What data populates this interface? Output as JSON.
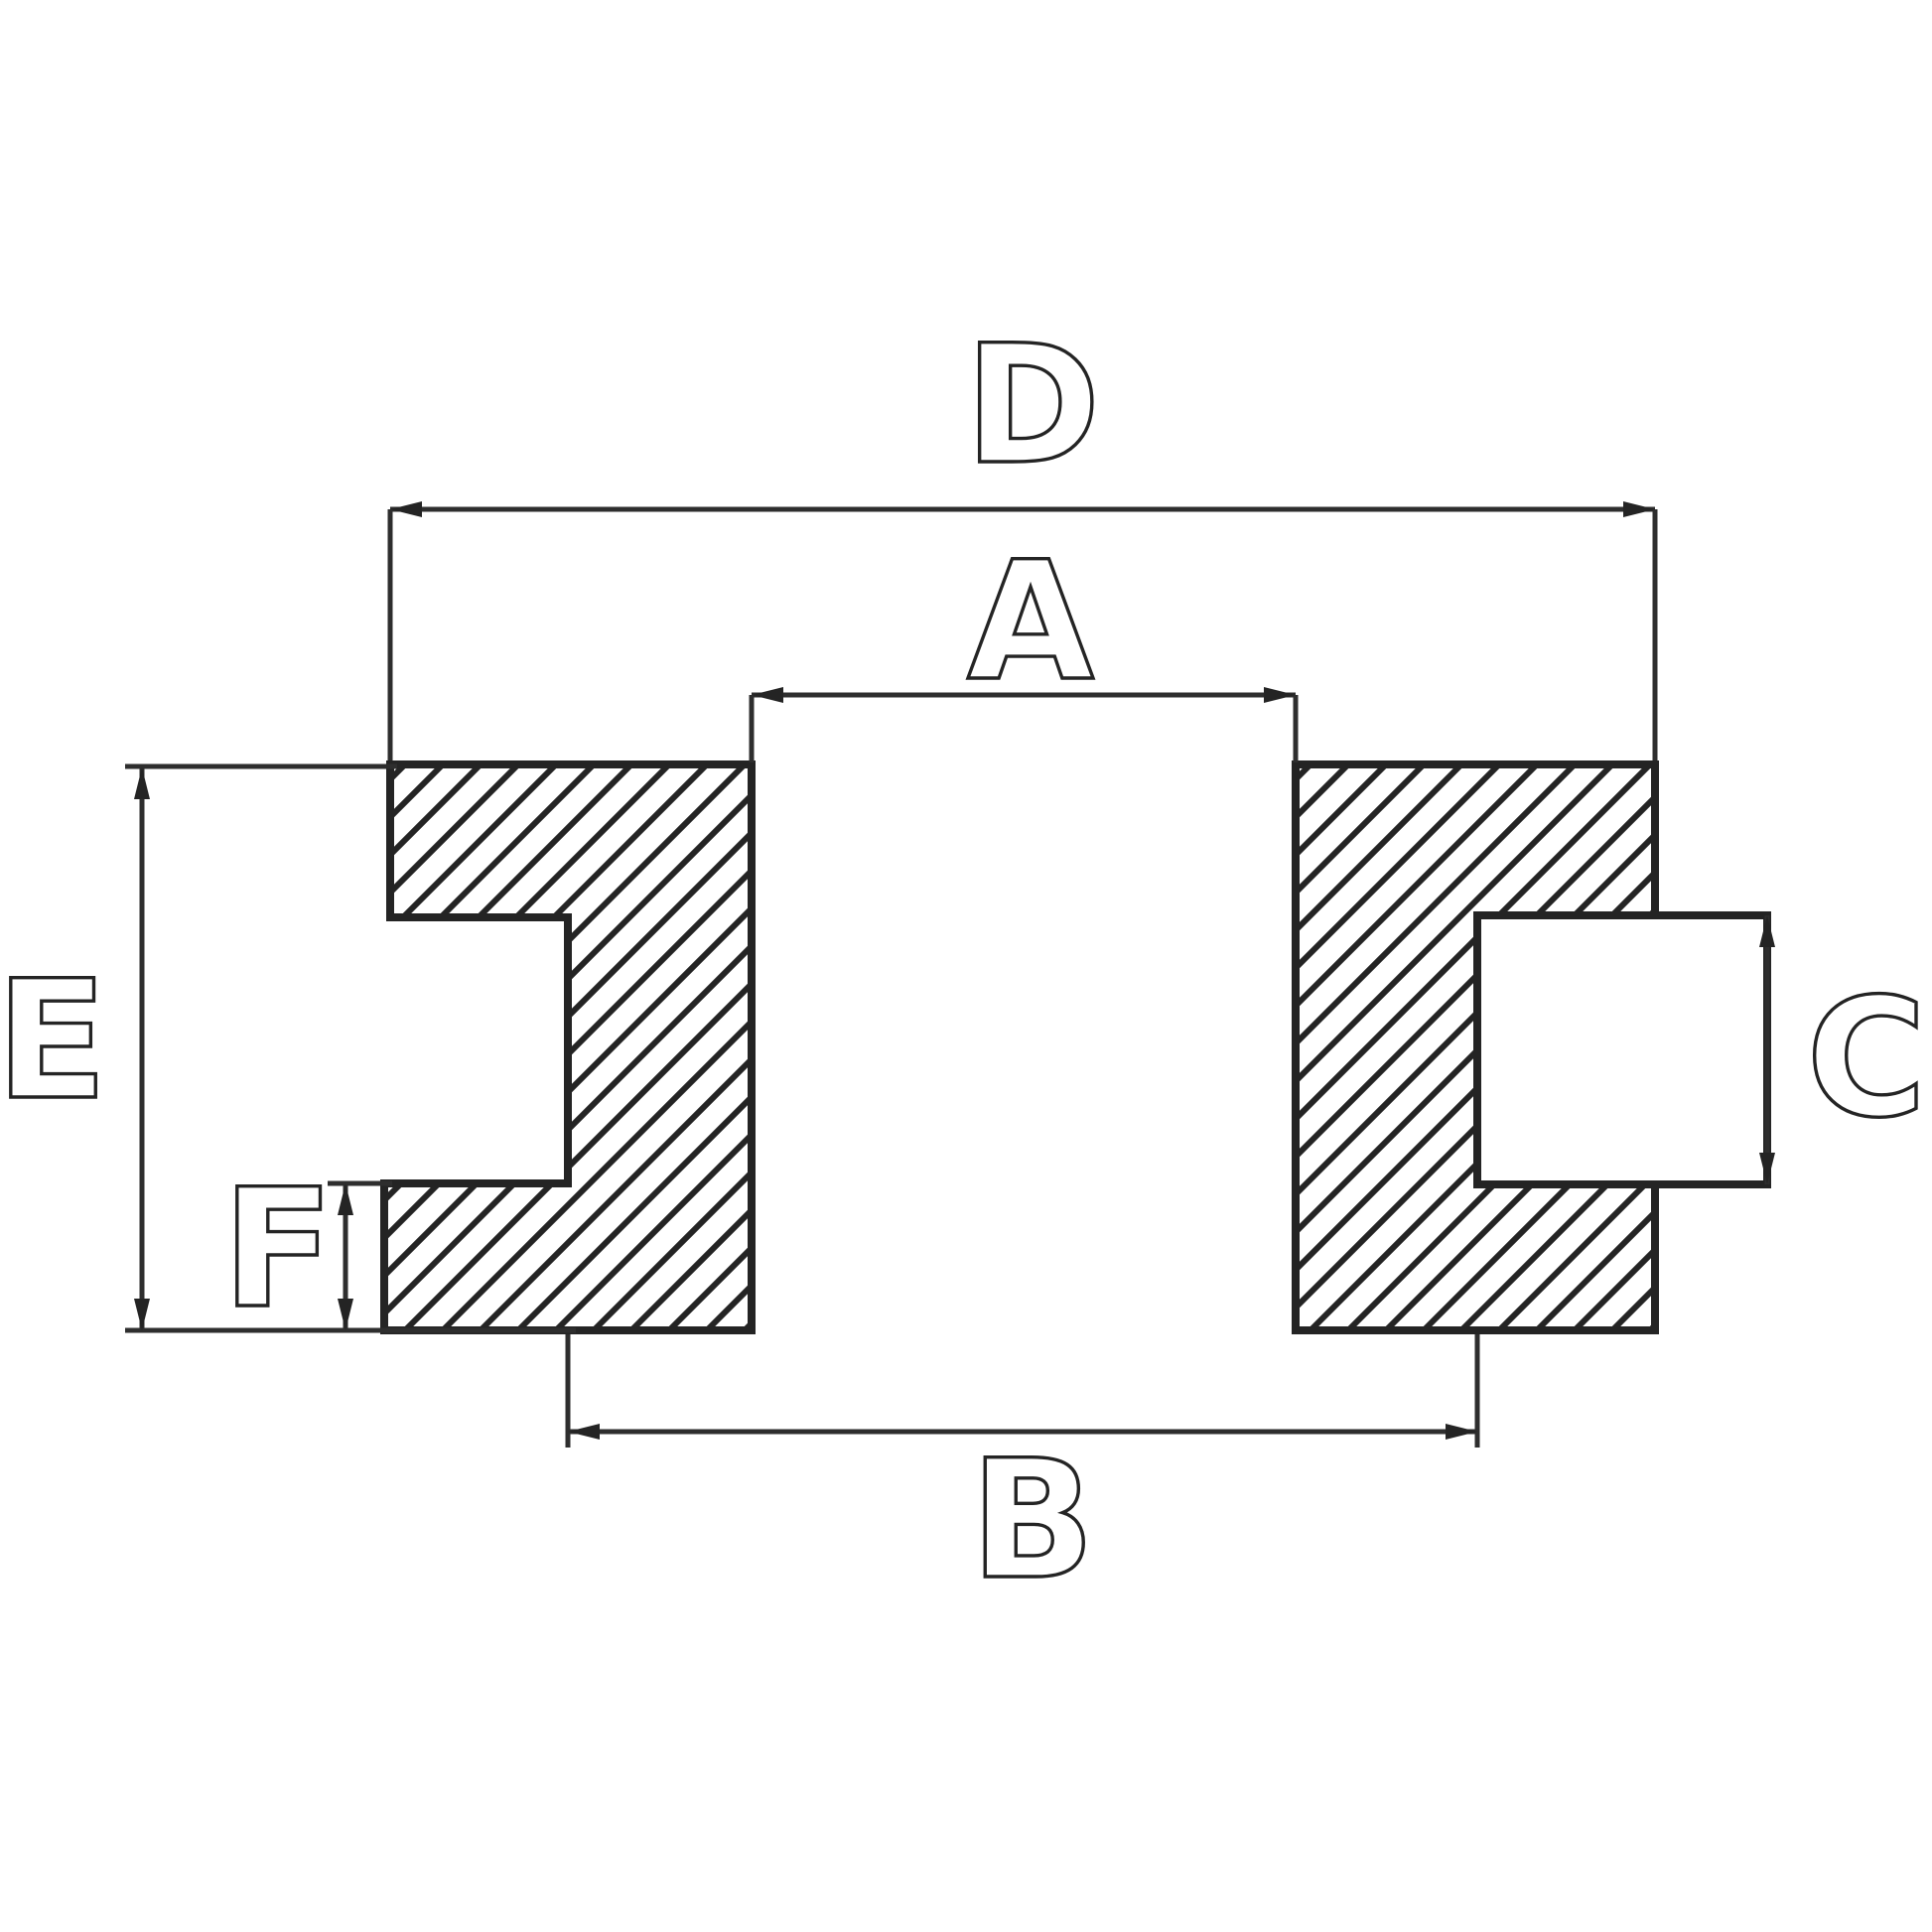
{
  "drawing": {
    "background_color": "#ffffff",
    "line_color": "#242424",
    "hatch_style": "diagonal-45deg"
  },
  "labels": {
    "D": "D",
    "A": "A",
    "E": "E",
    "C": "C",
    "F": "F",
    "B": "B"
  }
}
